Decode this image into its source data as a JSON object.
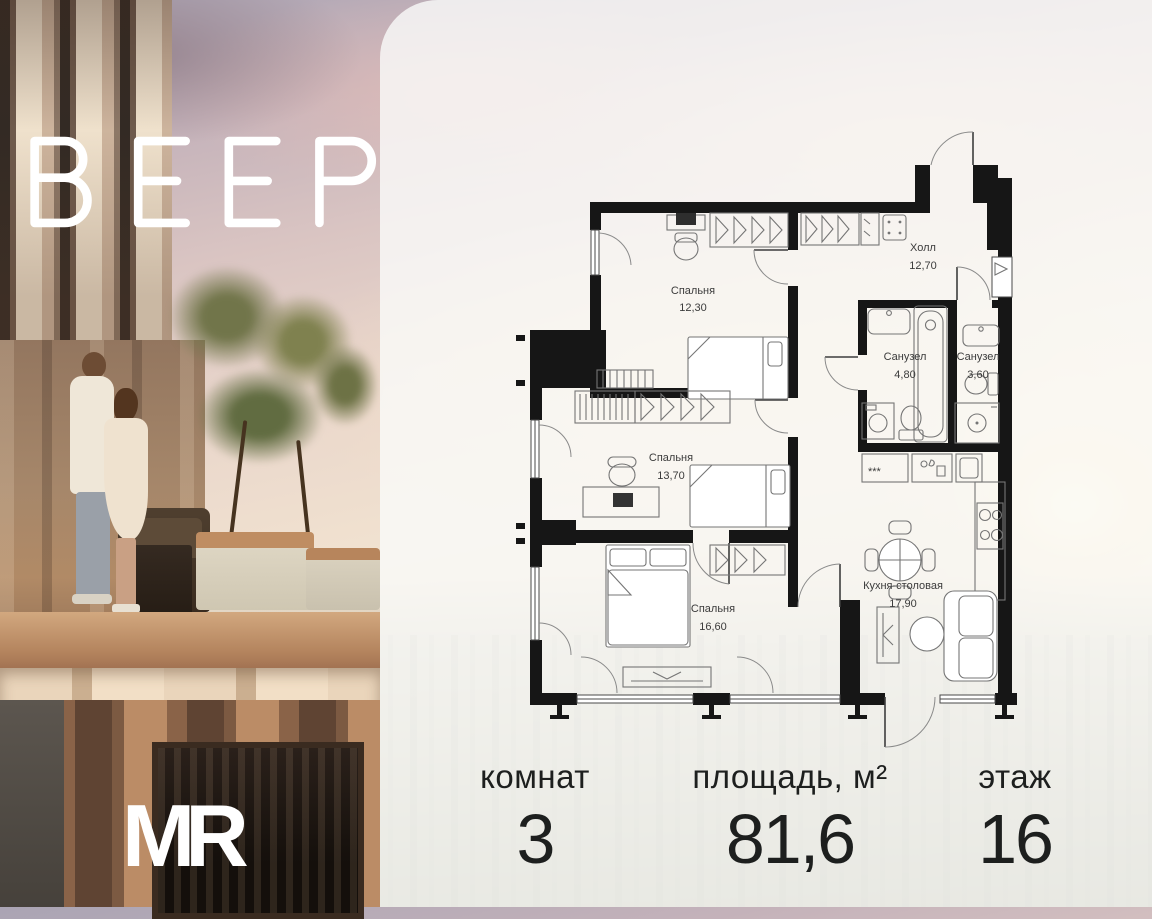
{
  "brand": {
    "logo_text": "ВЕЕР",
    "developer_logo": "MR"
  },
  "plan": {
    "rooms": [
      {
        "id": "bedroom-1",
        "name": "Спальня",
        "area": "12,30"
      },
      {
        "id": "hall",
        "name": "Холл",
        "area": "12,70"
      },
      {
        "id": "bathroom-1",
        "name": "Санузел",
        "area": "4,80"
      },
      {
        "id": "bathroom-2",
        "name": "Санузел",
        "area": "3,60"
      },
      {
        "id": "bedroom-2",
        "name": "Спальня",
        "area": "13,70"
      },
      {
        "id": "bedroom-3",
        "name": "Спальня",
        "area": "16,60"
      },
      {
        "id": "kitchen",
        "name": "Кухня-столовая",
        "area": "17,90"
      }
    ]
  },
  "stats": {
    "columns": [
      {
        "label": "комнат",
        "value": "3"
      },
      {
        "label": "площадь, м²",
        "value": "81,6"
      },
      {
        "label": "этаж",
        "value": "16"
      }
    ]
  },
  "colors": {
    "wall": "#161616",
    "card_bg": "rgba(250,251,250,0.8)",
    "text": "#1d1f1e"
  }
}
